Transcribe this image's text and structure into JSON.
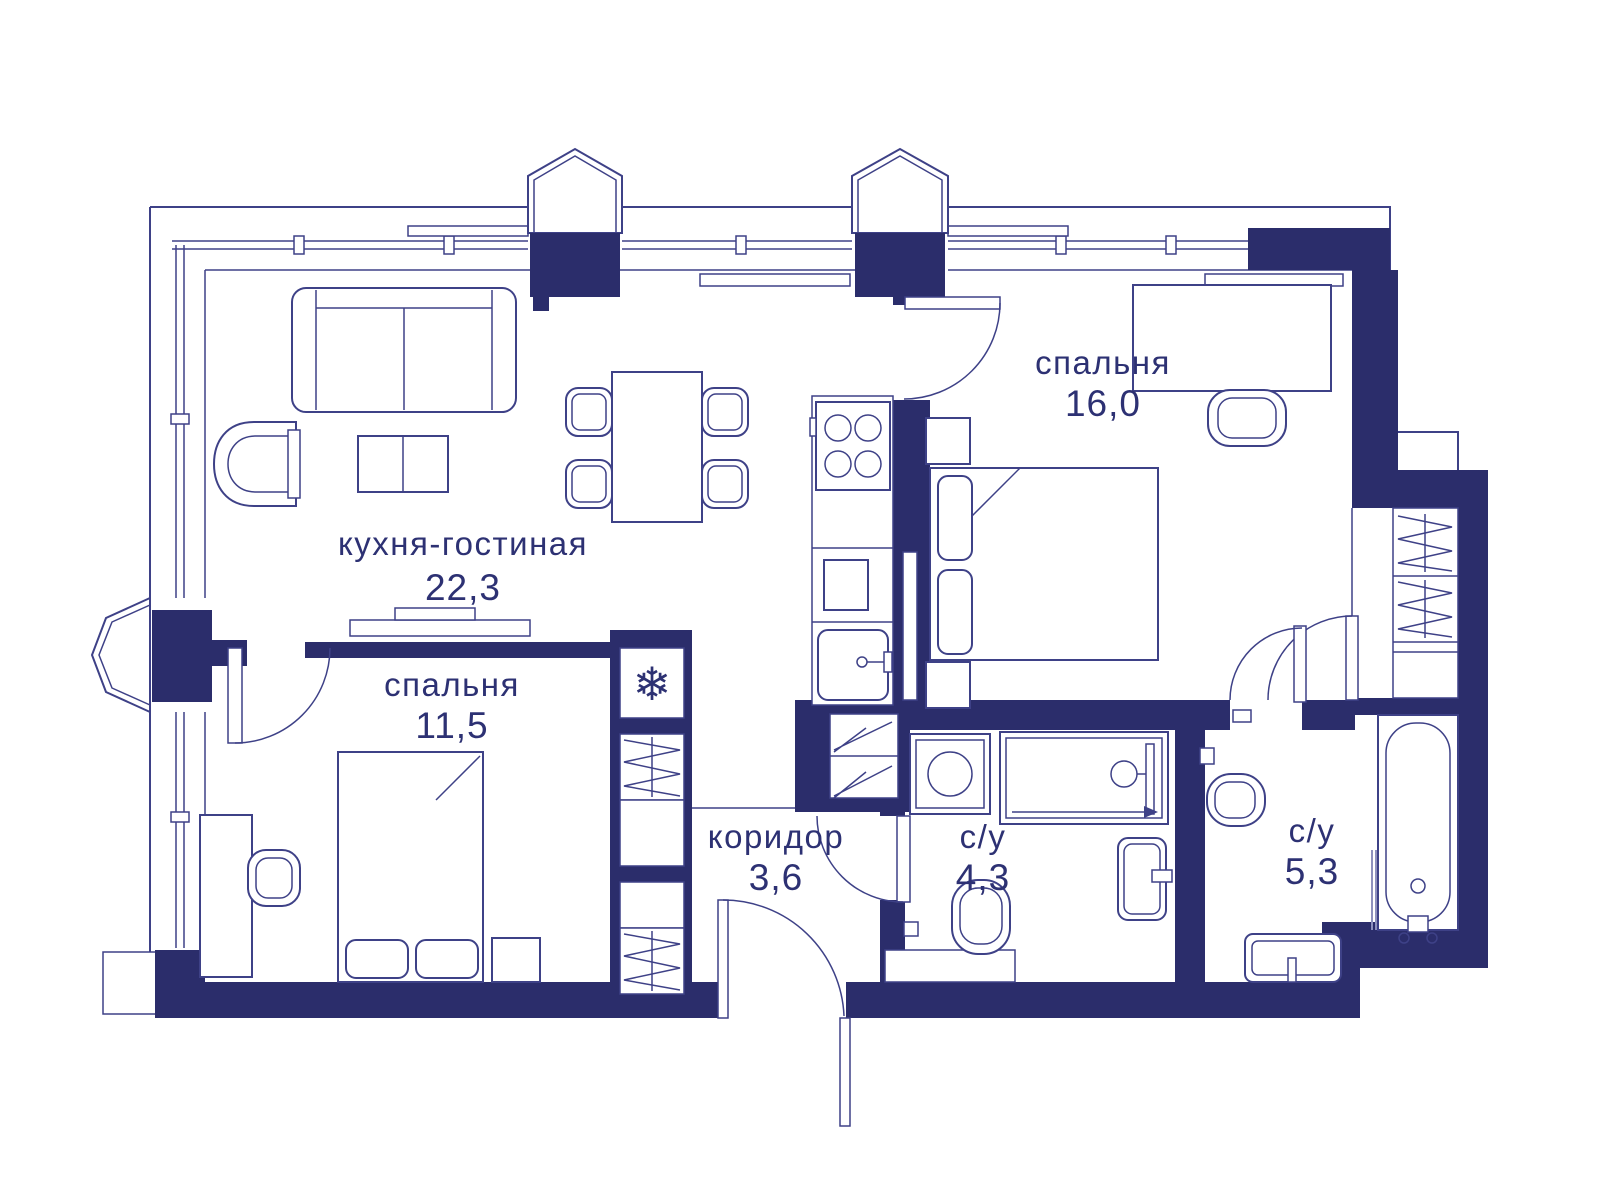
{
  "plan": {
    "type": "apartment-floor-plan",
    "colors": {
      "wall": "#2b2d6b",
      "line": "#3e4187",
      "text": "#2d3173",
      "background": "#ffffff"
    },
    "rooms": [
      {
        "id": "kitchen-living",
        "name": "кухня-гостиная",
        "area": "22,3"
      },
      {
        "id": "bedroom-16",
        "name": "спальня",
        "area": "16,0"
      },
      {
        "id": "bedroom-11",
        "name": "спальня",
        "area": "11,5"
      },
      {
        "id": "corridor",
        "name": "коридор",
        "area": "3,6"
      },
      {
        "id": "bathroom-4",
        "name": "с/у",
        "area": "4,3"
      },
      {
        "id": "bathroom-5",
        "name": "с/у",
        "area": "5,3"
      }
    ],
    "icons": {
      "fridge": "❄"
    }
  }
}
